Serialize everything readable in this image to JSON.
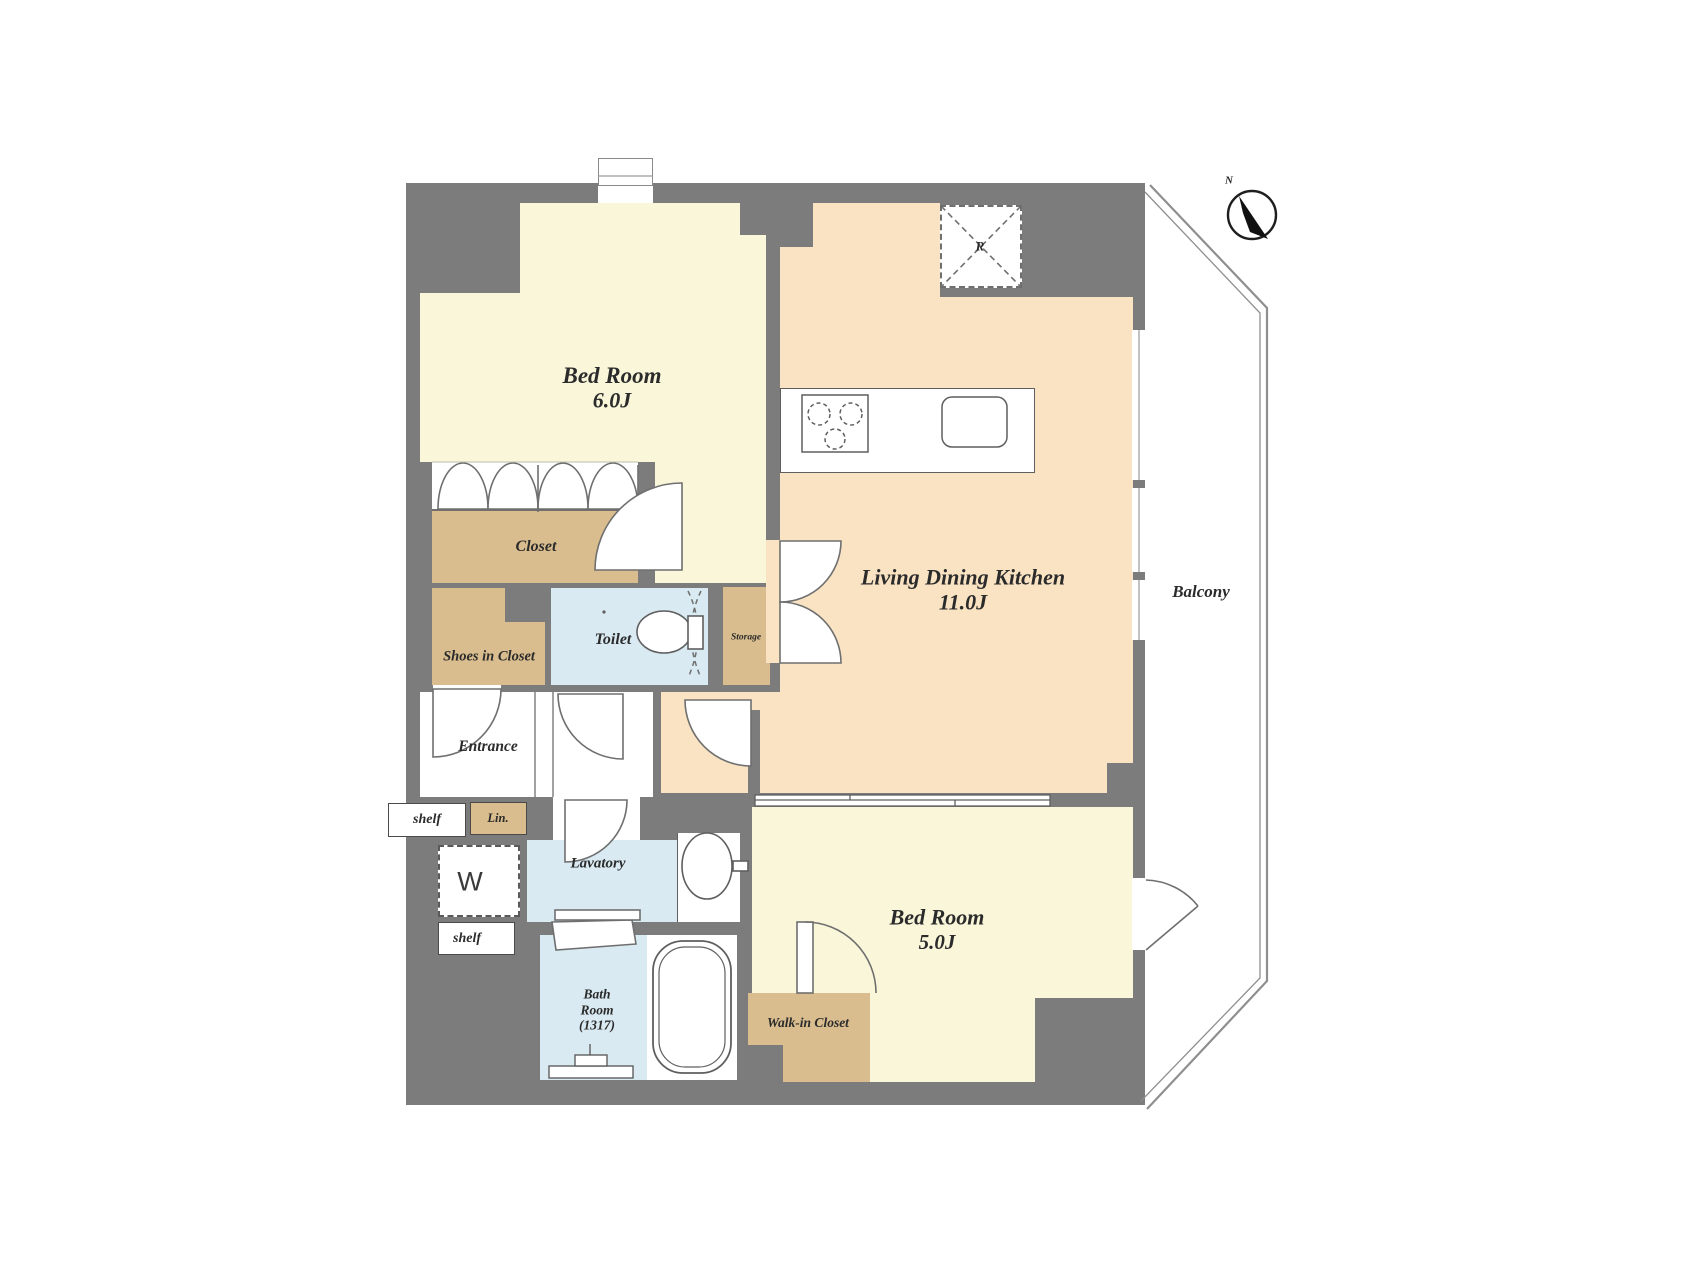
{
  "plan": {
    "rooms": {
      "bedroom_main": {
        "label": "Bed Room",
        "area": "6.0J"
      },
      "ldk": {
        "label": "Living Dining Kitchen",
        "area": "11.0J"
      },
      "bedroom_second": {
        "label": "Bed Room",
        "area": "5.0J"
      },
      "closet": {
        "label": "Closet"
      },
      "shoes_in_closet": {
        "label": "Shoes in Closet"
      },
      "toilet": {
        "label": "Toilet"
      },
      "storage": {
        "label": "Storage"
      },
      "entrance": {
        "label": "Entrance"
      },
      "lavatory": {
        "label": "Lavatory"
      },
      "bathroom": {
        "label_line1": "Bath",
        "label_line2": "Room",
        "label_line3": "(1317)"
      },
      "walk_in_closet": {
        "label": "Walk-in Closet"
      },
      "balcony": {
        "label": "Balcony"
      }
    },
    "fixtures": {
      "shelf_entrance": "shelf",
      "linen_cabinet": "Lin.",
      "washer": "W",
      "shelf_lower": "shelf",
      "range_hood": "R",
      "compass_north": "N"
    },
    "colors": {
      "wall": "#7c7c7c",
      "bedroom_cream": "#f9f6da",
      "ldk_peach": "#f9e3c3",
      "closet_tan": "#d9bd8e",
      "wet_area_blue": "#d9eaf2",
      "outline": "#5f5f5f"
    }
  }
}
